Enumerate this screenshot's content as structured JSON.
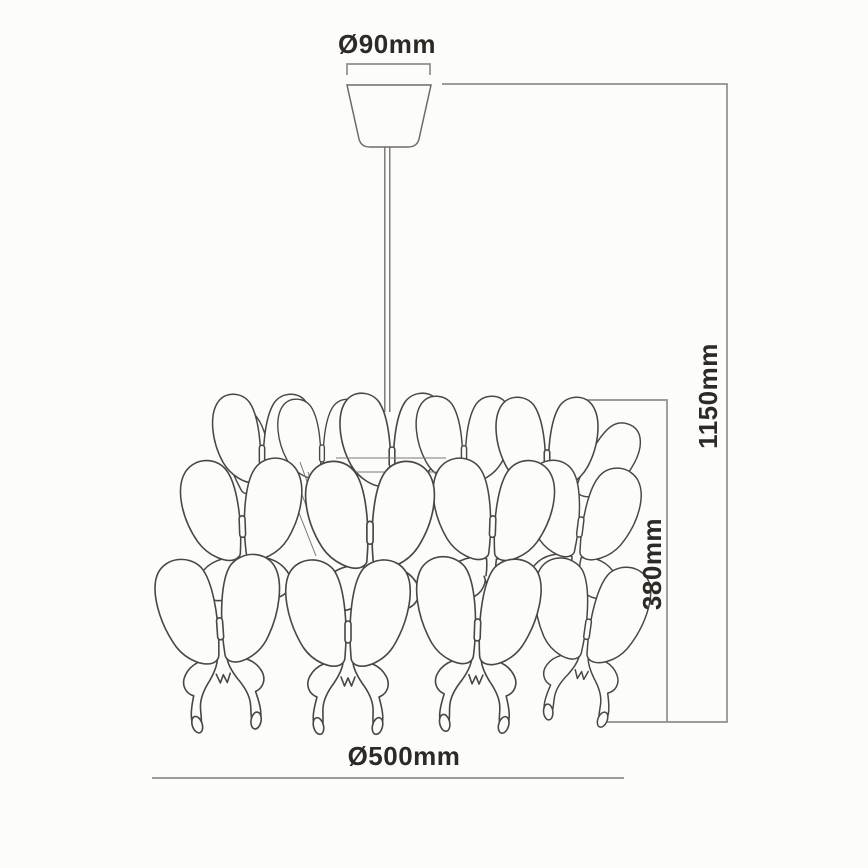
{
  "diagram": {
    "subject": "butterfly-pendant-chandelier-dimension-drawing",
    "labels": {
      "canopy_diameter": "Ø90mm",
      "overall_height": "1150mm",
      "shade_height": "380mm",
      "shade_diameter": "Ø500mm"
    },
    "shade": {
      "butterfly_rows": 3
    },
    "colors": {
      "background": "#fcfcfa",
      "dimension_line": "#8f8f8f",
      "artwork_line": "#4a4742",
      "text": "#2d2a26"
    }
  }
}
